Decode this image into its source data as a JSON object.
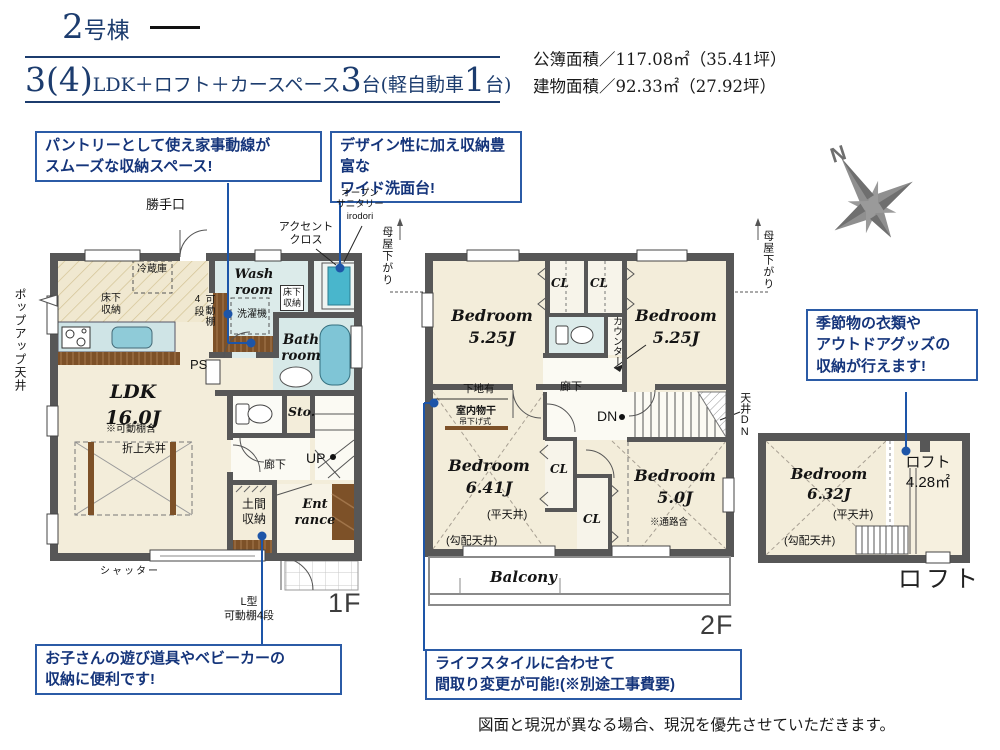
{
  "header": {
    "building_num": "2",
    "building_suffix": "号棟",
    "plan_big1": "3(4)",
    "plan_small1": "LDK＋ロフト＋カースペース",
    "plan_big2": "3",
    "plan_small2": "台(軽自動車",
    "plan_big3": "1",
    "plan_small3": "台)",
    "area_line1": "公簿面積／117.08㎡（35.41坪）",
    "area_line2": "建物面積／92.33㎡（27.92坪）"
  },
  "callouts": {
    "pantry": "パントリーとして使え家事動線が\nスムーズな収納スペース!",
    "vanity": "デザイン性に加え収納豊富な\nワイド洗面台!",
    "kids": "お子さんの遊び道具やベビーカーの\n収納に便利です!",
    "lifestyle": "ライフスタイルに合わせて\n間取り変更が可能!(※別途工事費要)",
    "seasonal": "季節物の衣類や\nアウトドアグッズの\n収納が行えます!"
  },
  "floor1": {
    "back_door": "勝手口",
    "open_sanitary": "オープン\nサニタリー\nirodori",
    "accent_cloth": "アクセント\nクロス",
    "popup_ceiling": "ポップアップ天井",
    "fridge": "冷蔵庫",
    "underfloor1": "床下\n収納",
    "movable_shelf": "可動棚\n4段",
    "ps": "PS",
    "ldk": "LDK\n16.0J",
    "shelf_note": "※可動棚含",
    "coffered": "折上天井",
    "washroom": "Wash\nroom",
    "underfloor2": "床下\n収納",
    "washer": "洗濯機",
    "bathroom": "Bath\nroom",
    "storage": "Sto.",
    "hallway": "廊下",
    "up": "UP",
    "doma": "土間\n収納",
    "entrance": "Ent\nrance",
    "shutter": "シャッター",
    "l_shelf": "L型\n可動棚4段",
    "floor_label": "1F"
  },
  "floor2": {
    "moya_left": "母屋下がり",
    "moya_right": "母屋下がり",
    "bedroom_a": "Bedroom\n5.25J",
    "bedroom_b": "Bedroom\n5.25J",
    "cl1": "CL",
    "cl2": "CL",
    "cl3": "CL",
    "cl4": "CL",
    "counter": "カウンター",
    "hallway": "廊下",
    "backing": "下地有",
    "dn": "DN",
    "ceiling_dn": "天井DN",
    "indoor_drying": "室内物干",
    "hanging_type": "吊下げ式",
    "bedroom_c": "Bedroom\n6.41J",
    "flat_ceiling": "(平天井)",
    "sloped_ceiling": "(勾配天井)",
    "bedroom_d": "Bedroom\n5.0J",
    "passage_note": "※通路含",
    "balcony": "Balcony",
    "floor_label": "2F"
  },
  "loft": {
    "bedroom": "Bedroom\n6.32J",
    "flat_ceiling": "(平天井)",
    "sloped_ceiling": "(勾配天井)",
    "loft_area": "ロフト\n4.28㎡",
    "loft_label": "ロフト"
  },
  "compass": {
    "north": "N"
  },
  "footer": {
    "disclaimer": "図面と現況が異なる場合、現況を優先させていただきます。"
  },
  "colors": {
    "accent_blue": "#1d55a8",
    "callout_border": "#2b5ba6",
    "title_navy": "#1c3c6e",
    "wall": "#575757",
    "floor_cream": "#f3edda",
    "water_blue": "#dcebea",
    "tub_teal": "#7fc5d6",
    "wood_brown": "#7d5128"
  }
}
